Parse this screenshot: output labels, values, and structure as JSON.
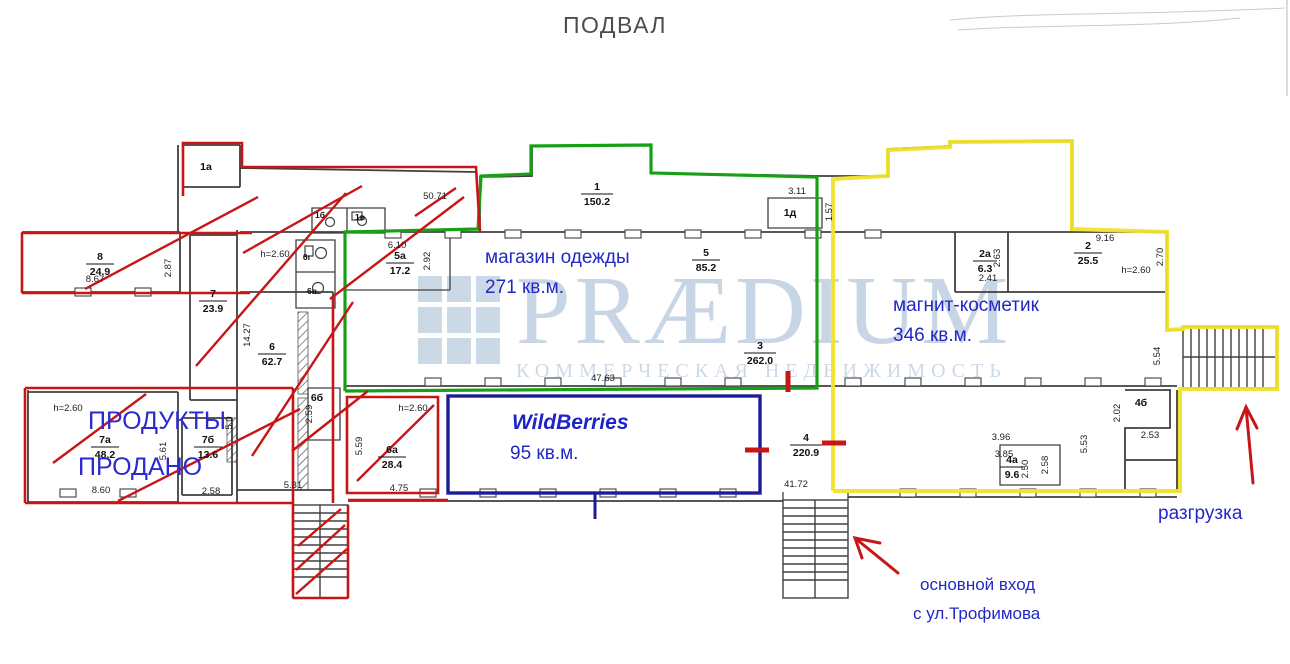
{
  "title": "ПОДВАЛ",
  "watermark": {
    "brand": "PRÆDIUM",
    "tagline": "КОММЕРЧЕСКАЯ НЕДВИЖИМОСТЬ"
  },
  "tenants": {
    "clothing": {
      "name": "магазин одежды",
      "area": "271 кв.м."
    },
    "magnit": {
      "name": "магнит-косметик",
      "area": "346 кв.м."
    },
    "wildberries": {
      "name": "WildBerries",
      "area": "95 кв.м."
    },
    "products": {
      "name": "ПРОДУКТЫ",
      "status": "ПРОДАНО"
    }
  },
  "annotations": {
    "unloading": "разгрузка",
    "entrance_line1": "основной вход",
    "entrance_line2": "с ул.Трофимова"
  },
  "rooms": {
    "r1": {
      "num": "1",
      "area": "150.2"
    },
    "r1a": {
      "num": "1а"
    },
    "r1b": {
      "num": "1б"
    },
    "r1v": {
      "num": "1в"
    },
    "r1d": {
      "num": "1д"
    },
    "r2": {
      "num": "2",
      "area": "25.5"
    },
    "r2a": {
      "num": "2а",
      "area": "6.3"
    },
    "r3": {
      "num": "3",
      "area": "262.0"
    },
    "r4": {
      "num": "4",
      "area": "220.9"
    },
    "r4a": {
      "num": "4а",
      "area": "9.6"
    },
    "r4b": {
      "num": "4б"
    },
    "r5": {
      "num": "5",
      "area": "85.2"
    },
    "r5a": {
      "num": "5а",
      "area": "17.2"
    },
    "r6": {
      "num": "6",
      "area": "62.7"
    },
    "r6a": {
      "num": "6а",
      "area": "28.4"
    },
    "r6b": {
      "num": "6б"
    },
    "r6v": {
      "num": "6в"
    },
    "r6g": {
      "num": "6г"
    },
    "r7": {
      "num": "7",
      "area": "23.9"
    },
    "r7a": {
      "num": "7а",
      "area": "48.2"
    },
    "r7b": {
      "num": "7б",
      "area": "13.6"
    },
    "r8": {
      "num": "8",
      "area": "24.9"
    }
  },
  "dims": {
    "d50_71": "50.71",
    "d8_67": "8.67",
    "d2_87": "2.87",
    "d14_27": "14.27",
    "h_2_60": "h=2.60",
    "d6_10": "6.10",
    "d2_92": "2.92",
    "d3_11": "3.11",
    "d1_57": "1.57",
    "d9_16": "9.16",
    "d2_63": "2.63",
    "d2_41": "2.41",
    "d2_70": "2.70",
    "d47_63": "47.63",
    "d41_72": "41.72",
    "d5_54": "5.54",
    "d2_02": "2.02",
    "d2_53": "2.53",
    "d5_53": "5.53",
    "d3_96": "3.96",
    "d3_85": "3.85",
    "d2_50": "2.50",
    "d2_58": "2.58",
    "d8_60": "8.60",
    "d5_61": "5.61",
    "d5_0": "5.0",
    "d5_31": "5.31",
    "d5_59": "5.59",
    "d4_75": "4.75",
    "d2_59": "2.59"
  },
  "colors": {
    "red_outline": "#c81616",
    "green_outline": "#17a017",
    "yellow_outline": "#f0e32b",
    "blue_outline": "#1c1c96",
    "label_blue": "#2328c4",
    "wall_gray": "#404040",
    "watermark_blue": "#c8d5e4"
  }
}
